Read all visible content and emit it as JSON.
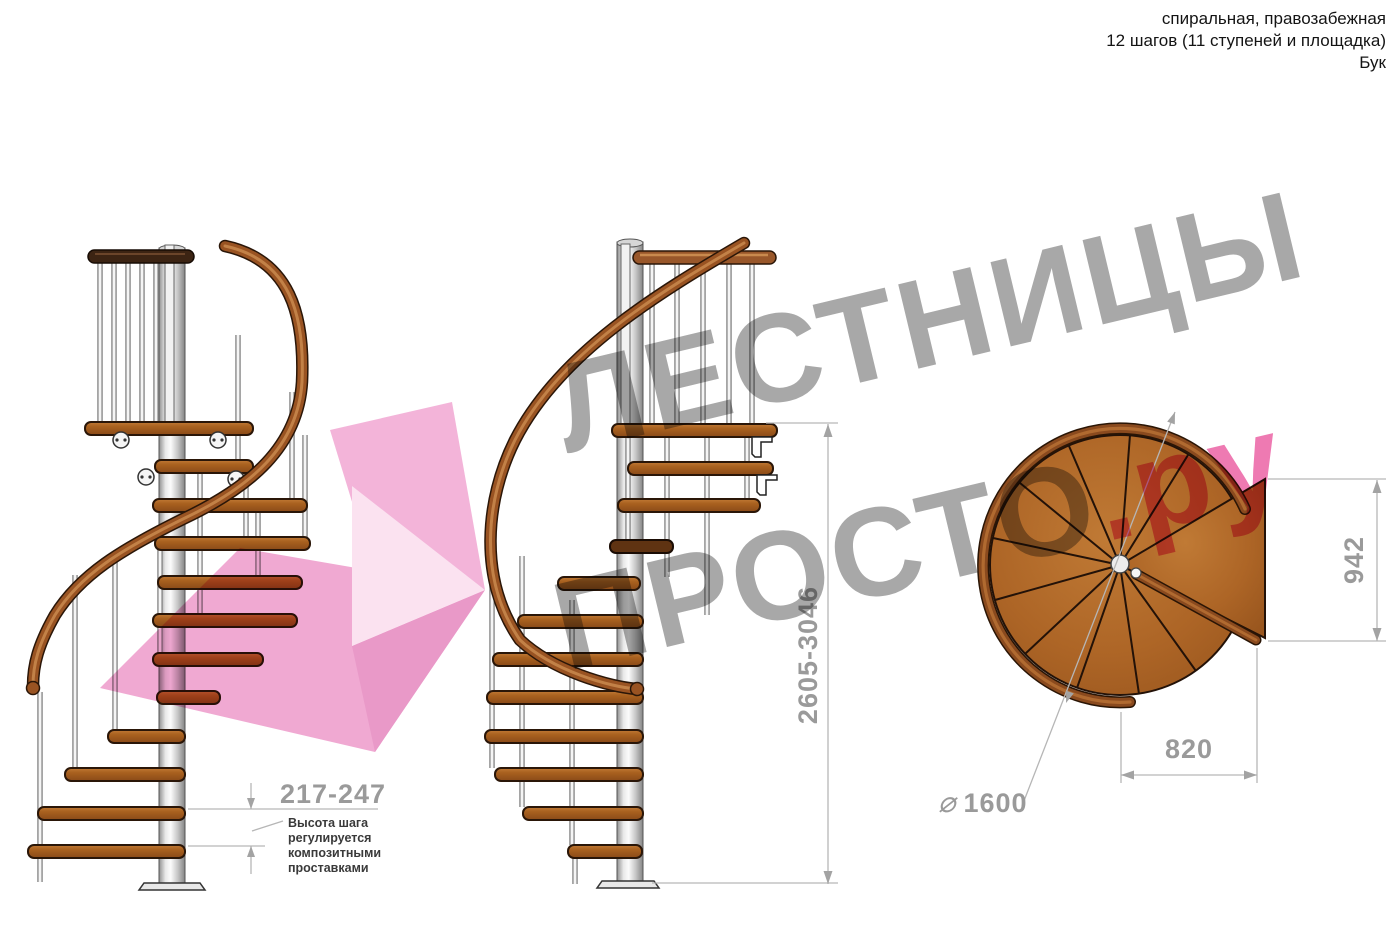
{
  "header": {
    "line1": "спиральная, правозабежная",
    "line2": "12 шагов (11 ступеней и площадка)",
    "line3": "Бук"
  },
  "watermark": {
    "brand_word1": "ЛЕСТНИЦЫ",
    "brand_word2": "ПРОСТО",
    "brand_suffix": ".ру"
  },
  "dims": {
    "total_height": "2605-3046",
    "step_height": "217-247",
    "note_line1": "Высота шага",
    "note_line2": "регулируется",
    "note_line3": "композитными",
    "note_line4": "проставками",
    "landing_span": "942",
    "tread_span": "820",
    "diameter_symbol": "⌀",
    "diameter_value": "1600"
  },
  "colors": {
    "watermark_gray": "#a8a8a8",
    "watermark_pink": "#ee7ab2",
    "logo_pink": "#f2a9d3",
    "wood": "#a9611f",
    "wood_dark": "#5f3312",
    "rail_wood": "#995322",
    "metal_light": "#f2f2f2",
    "dim_line": "#b6b6b6",
    "dim_text": "#9a9a9a",
    "note_text": "#3a3a3a"
  }
}
